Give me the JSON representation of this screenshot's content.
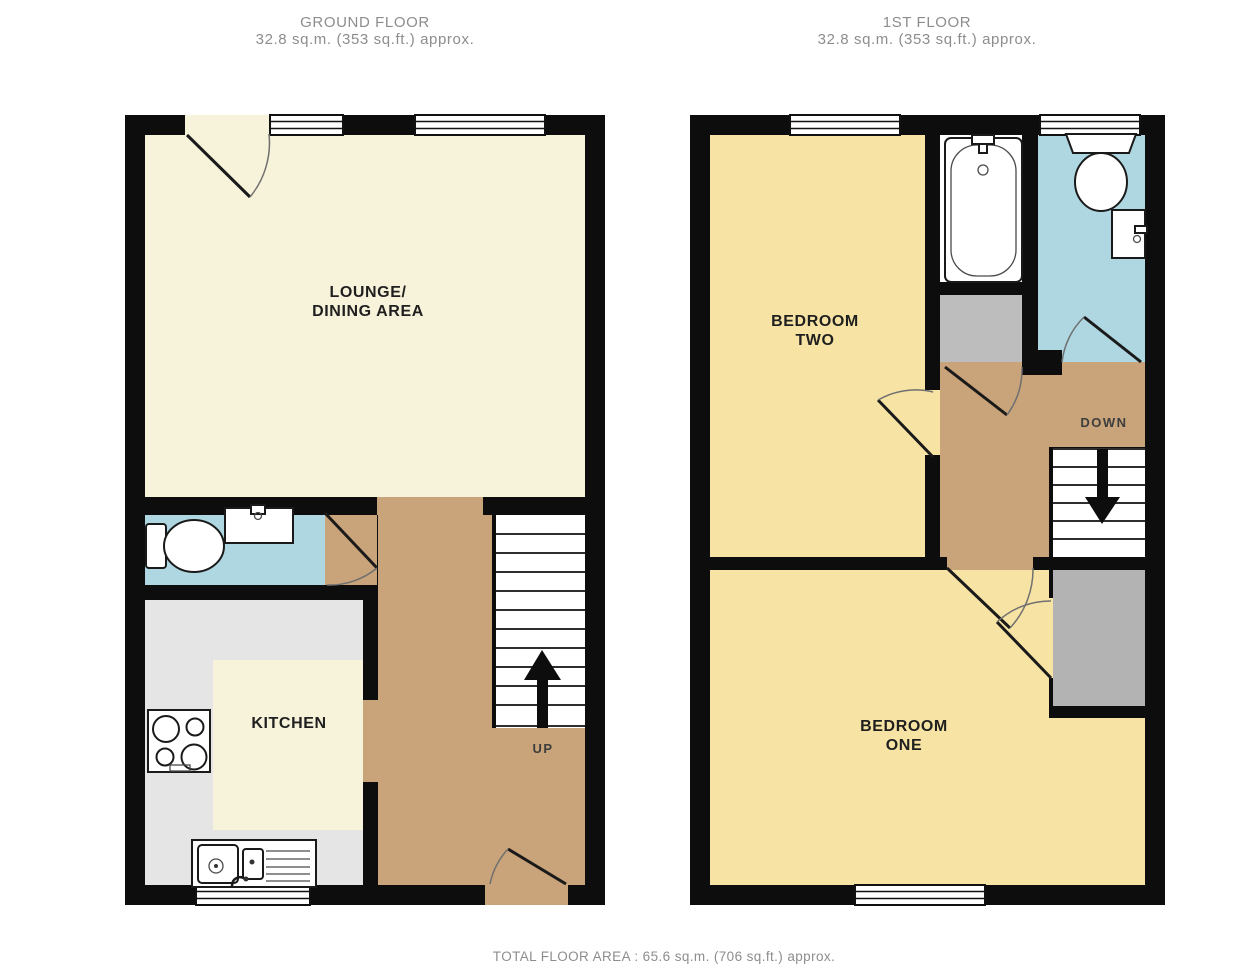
{
  "page": {
    "background": "#ffffff"
  },
  "titles": {
    "ground_floor": {
      "name": "GROUND FLOOR",
      "area": "32.8 sq.m. (353 sq.ft.) approx."
    },
    "first_floor": {
      "name": "1ST FLOOR",
      "area": "32.8 sq.m. (353 sq.ft.) approx."
    },
    "total_area": "TOTAL FLOOR AREA : 65.6 sq.m. (706 sq.ft.) approx."
  },
  "rooms": {
    "lounge": {
      "label_line1": "LOUNGE/",
      "label_line2": "DINING AREA"
    },
    "kitchen": {
      "label": "KITCHEN"
    },
    "bedroom_two": {
      "label_line1": "BEDROOM",
      "label_line2": "TWO"
    },
    "bedroom_one": {
      "label_line1": "BEDROOM",
      "label_line2": "ONE"
    }
  },
  "stairs": {
    "up_label": "UP",
    "down_label": "DOWN"
  },
  "colors": {
    "wall": "#0d0d0d",
    "lounge_floor": "#f7f2da",
    "kitchen_floor": "#e5e5e5",
    "bedroom_floor": "#f7e4a4",
    "bathroom_floor": "#aed7e1",
    "hall_floor": "#c9a379",
    "cupboard": "#bdbdbd",
    "cupboard_dark": "#b3b3b3",
    "title_text": "#8d8d8d",
    "label_text": "#1f1f1f",
    "direction_text": "#3d3d3d"
  }
}
